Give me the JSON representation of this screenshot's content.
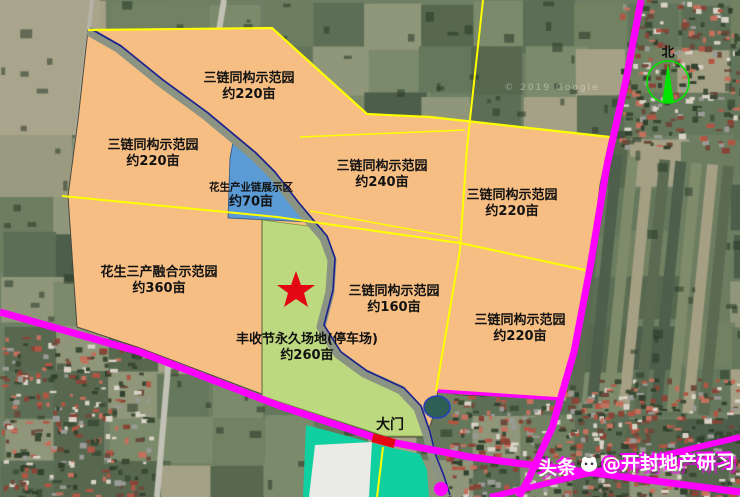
{
  "zones": [
    {
      "id": "top",
      "name": "三链同构示范园",
      "area": "约220亩"
    },
    {
      "id": "left",
      "name": "三链同构示范园",
      "area": "约220亩"
    },
    {
      "id": "peanut-chain",
      "name": "花生产业链展示区",
      "area": "约70亩"
    },
    {
      "id": "middle",
      "name": "三链同构示范园",
      "area": "约240亩"
    },
    {
      "id": "right-top",
      "name": "三链同构示范园",
      "area": "约220亩"
    },
    {
      "id": "integration",
      "name": "花生三产融合示范园",
      "area": "约360亩"
    },
    {
      "id": "harvest",
      "name": "丰收节永久场地(停车场)",
      "area": "约260亩"
    },
    {
      "id": "mid-bottom",
      "name": "三链同构示范园",
      "area": "约160亩"
    },
    {
      "id": "right-bottom",
      "name": "三链同构示范园",
      "area": "约220亩"
    }
  ],
  "gate_label": "大门",
  "compass_label": "北",
  "satellite_credit": "© 2019 Google",
  "watermark": {
    "brand": "头条",
    "handle": "@开封地产研习"
  },
  "colors": {
    "zone_orange": "#F7BE83",
    "zone_blue": "#5B9BD5",
    "zone_green": "#BCD97F",
    "zone_teal": "#10CFA0",
    "boundary_yellow": "#FFFF00",
    "road_magenta": "#FF00FF",
    "marker_red": "#E30613",
    "compass_green": "#00E400"
  }
}
